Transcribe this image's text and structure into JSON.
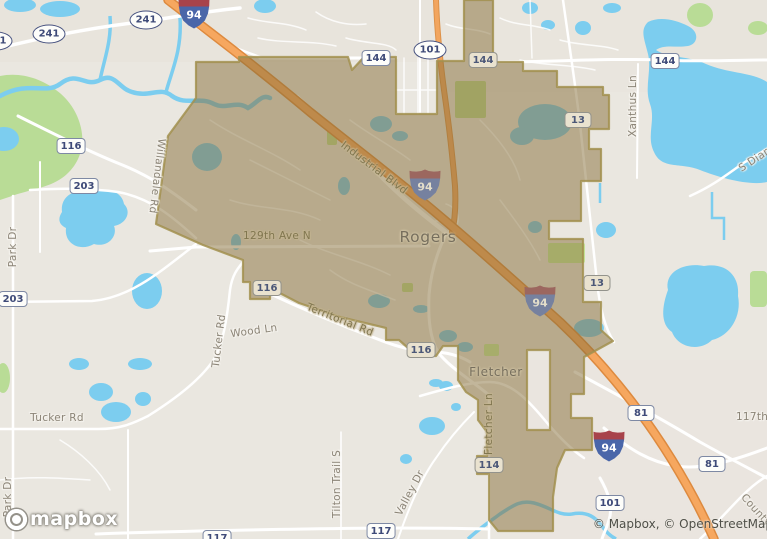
{
  "map": {
    "watermark": "mapbox",
    "attribution": "© Mapbox, © OpenStreetMap",
    "city_labels": [
      {
        "text": "Rogers",
        "x": 428,
        "y": 237,
        "size": 15.5
      },
      {
        "text": "Fletcher",
        "x": 496,
        "y": 372,
        "size": 12
      }
    ],
    "road_labels": [
      {
        "text": "Industrial Blvd",
        "x": 374,
        "y": 168,
        "rot": 37,
        "muted": true
      },
      {
        "text": "129th Ave N",
        "x": 277,
        "y": 236,
        "rot": 0,
        "muted": true
      },
      {
        "text": "Territorial Rd",
        "x": 340,
        "y": 320,
        "rot": 22,
        "muted": true
      },
      {
        "text": "Wood Ln",
        "x": 254,
        "y": 331,
        "rot": -8,
        "muted": false
      },
      {
        "text": "Tucker Rd",
        "x": 219,
        "y": 341,
        "rot": -83,
        "muted": false
      },
      {
        "text": "Tucker Rd",
        "x": 57,
        "y": 418,
        "rot": 0,
        "muted": false
      },
      {
        "text": "Willandale Rd",
        "x": 157,
        "y": 176,
        "rot": 97,
        "muted": false
      },
      {
        "text": "Park Dr",
        "x": 13,
        "y": 247,
        "rot": -90,
        "muted": false
      },
      {
        "text": "Park Dr",
        "x": 8,
        "y": 497,
        "rot": -90,
        "muted": false
      },
      {
        "text": "Xanthus Ln",
        "x": 633,
        "y": 106,
        "rot": -90,
        "muted": false
      },
      {
        "text": "S Diamond Lake Rd",
        "x": 785,
        "y": 140,
        "rot": -33,
        "muted": false
      },
      {
        "text": "Fletcher Ln",
        "x": 489,
        "y": 424,
        "rot": -90,
        "muted": true
      },
      {
        "text": "Tilton Trail S",
        "x": 337,
        "y": 484,
        "rot": -90,
        "muted": false
      },
      {
        "text": "Valley Dr",
        "x": 410,
        "y": 493,
        "rot": -62,
        "muted": false
      },
      {
        "text": "County Rd",
        "x": 762,
        "y": 517,
        "rot": 48,
        "muted": false
      },
      {
        "text": "117th Ave",
        "x": 764,
        "y": 417,
        "rot": 0,
        "muted": false
      }
    ],
    "shields": [
      {
        "type": "oval",
        "text": "241",
        "x": -4,
        "y": 41,
        "muted": false
      },
      {
        "type": "oval",
        "text": "241",
        "x": 49,
        "y": 34,
        "muted": false
      },
      {
        "type": "oval",
        "text": "241",
        "x": 146,
        "y": 20,
        "muted": false
      },
      {
        "type": "oval",
        "text": "101",
        "x": 430,
        "y": 50,
        "muted": false
      },
      {
        "type": "interstate",
        "text": "94",
        "x": 194,
        "y": 13,
        "muted": false
      },
      {
        "type": "interstate",
        "text": "94",
        "x": 425,
        "y": 185,
        "muted": true
      },
      {
        "type": "interstate",
        "text": "94",
        "x": 540,
        "y": 301,
        "muted": true
      },
      {
        "type": "interstate",
        "text": "94",
        "x": 609,
        "y": 446,
        "muted": false
      },
      {
        "type": "rect",
        "text": "144",
        "x": 376,
        "y": 58,
        "muted": false
      },
      {
        "type": "rect",
        "text": "144",
        "x": 483,
        "y": 60,
        "muted": true
      },
      {
        "type": "rect",
        "text": "144",
        "x": 665,
        "y": 61,
        "muted": false
      },
      {
        "type": "rect",
        "text": "13",
        "x": 578,
        "y": 120,
        "muted": true
      },
      {
        "type": "rect",
        "text": "13",
        "x": 597,
        "y": 283,
        "muted": true
      },
      {
        "type": "rect",
        "text": "116",
        "x": 71,
        "y": 146,
        "muted": false
      },
      {
        "type": "rect",
        "text": "203",
        "x": 84,
        "y": 186,
        "muted": false
      },
      {
        "type": "rect",
        "text": "203",
        "x": 13,
        "y": 299,
        "muted": false
      },
      {
        "type": "rect",
        "text": "116",
        "x": 267,
        "y": 288,
        "muted": true
      },
      {
        "type": "rect",
        "text": "116",
        "x": 421,
        "y": 350,
        "muted": true
      },
      {
        "type": "rect",
        "text": "114",
        "x": 489,
        "y": 465,
        "muted": true
      },
      {
        "type": "rect",
        "text": "81",
        "x": 641,
        "y": 413,
        "muted": false
      },
      {
        "type": "rect",
        "text": "81",
        "x": 712,
        "y": 464,
        "muted": false
      },
      {
        "type": "rect",
        "text": "117",
        "x": 217,
        "y": 538,
        "muted": false
      },
      {
        "type": "rect",
        "text": "117",
        "x": 381,
        "y": 531,
        "muted": false
      },
      {
        "type": "rect",
        "text": "101",
        "x": 610,
        "y": 503,
        "muted": false
      }
    ],
    "colors": {
      "land": "#eae7e0",
      "suburb": "#e7e3d9",
      "water": "#7ccdef",
      "park_green": "#b9dc96",
      "boundary_fill": "rgba(134,109,56,0.5)",
      "boundary_stroke": "#a2904f",
      "motorway_fill": "#f6a75f",
      "motorway_casing": "#dd8a3f",
      "road_white": "#ffffff",
      "shield_navy": "#3e4a78",
      "interstate_blue": "#4a66a9",
      "interstate_red": "#a8434b",
      "label_grey": "#8b8477"
    }
  }
}
